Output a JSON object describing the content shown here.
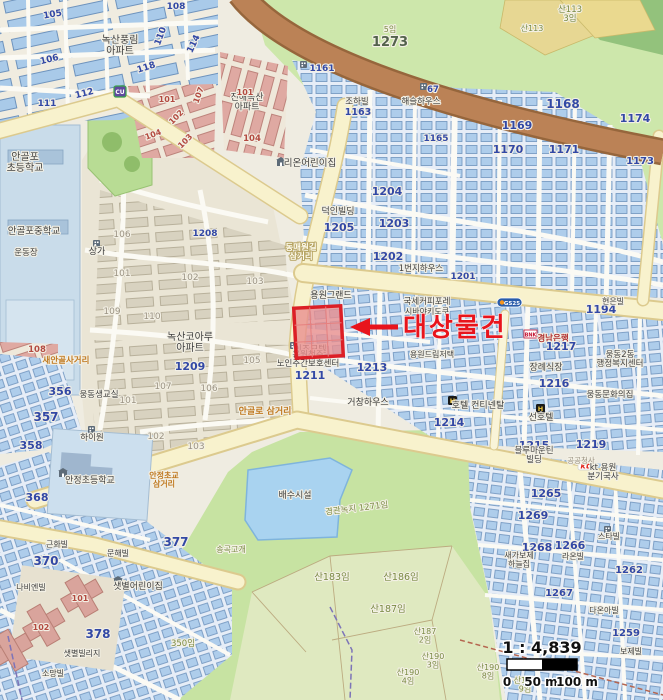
{
  "map": {
    "target": {
      "label": "대상물건",
      "color": "#e8141c"
    },
    "scalebar": {
      "ratio": "1 : 4,839",
      "tick0": "0",
      "tick1": "50 m",
      "tick2": "100 m"
    },
    "colors": {
      "target_red": "#e8141c",
      "parcel_fill": "#e88f8f",
      "building_blue": "#aecdeb",
      "road_yellow": "#f8f2cd",
      "road_brown": "#bb8256",
      "water_blue": "#a9d3f0",
      "green_hill": "#cde7ab"
    },
    "icons": [
      {
        "type": "cu",
        "x": 114,
        "y": 86
      },
      {
        "type": "gs25",
        "x": 497,
        "y": 298
      },
      {
        "type": "kt",
        "x": 578,
        "y": 461
      },
      {
        "type": "bnk",
        "x": 524,
        "y": 330
      },
      {
        "type": "school",
        "x": 276,
        "y": 157
      },
      {
        "type": "school",
        "x": 58,
        "y": 468
      },
      {
        "type": "school",
        "x": 113,
        "y": 576
      },
      {
        "type": "bld",
        "x": 93,
        "y": 240
      },
      {
        "type": "bld",
        "x": 300,
        "y": 61
      },
      {
        "type": "bld",
        "x": 420,
        "y": 83
      },
      {
        "type": "bld",
        "x": 290,
        "y": 342
      },
      {
        "type": "bld",
        "x": 88,
        "y": 426
      },
      {
        "type": "bld",
        "x": 604,
        "y": 526
      },
      {
        "type": "hotel",
        "x": 448,
        "y": 396
      },
      {
        "type": "hotel",
        "x": 536,
        "y": 404
      }
    ],
    "labels": [
      {
        "t": "108",
        "x": 176,
        "y": 9,
        "k": "bn",
        "s": 9
      },
      {
        "t": "105",
        "x": 53,
        "y": 17,
        "k": "bn",
        "s": 9,
        "r": -10
      },
      {
        "t": "녹산풍림\n아파트",
        "x": 120,
        "y": 43,
        "k": "nm",
        "s": 10
      },
      {
        "t": "110",
        "x": 163,
        "y": 37,
        "k": "bn",
        "s": 9,
        "r": -70
      },
      {
        "t": "114",
        "x": 196,
        "y": 45,
        "k": "bn",
        "s": 9,
        "r": -65
      },
      {
        "t": "106",
        "x": 50,
        "y": 62,
        "k": "bn",
        "s": 9,
        "r": -14
      },
      {
        "t": "118",
        "x": 147,
        "y": 70,
        "k": "bn",
        "s": 9,
        "r": -18
      },
      {
        "t": "112",
        "x": 85,
        "y": 96,
        "k": "bn",
        "s": 9,
        "r": -14
      },
      {
        "t": "111",
        "x": 47,
        "y": 106,
        "k": "bn",
        "s": 9
      },
      {
        "t": "101",
        "x": 167,
        "y": 102,
        "k": "pk",
        "s": 8
      },
      {
        "t": "107",
        "x": 201,
        "y": 96,
        "k": "pk",
        "s": 8,
        "r": -70
      },
      {
        "t": "102",
        "x": 178,
        "y": 119,
        "k": "pk",
        "s": 8,
        "r": -45
      },
      {
        "t": "104",
        "x": 154,
        "y": 137,
        "k": "pk",
        "s": 8,
        "r": -20
      },
      {
        "t": "103",
        "x": 187,
        "y": 143,
        "k": "pk",
        "s": 8,
        "r": -45
      },
      {
        "t": "진해녹산\n아파트",
        "x": 247,
        "y": 100,
        "k": "nm",
        "s": 9
      },
      {
        "t": "101",
        "x": 245,
        "y": 95,
        "k": "pk",
        "s": 8
      },
      {
        "t": "104",
        "x": 252,
        "y": 141,
        "k": "pk",
        "s": 8.5
      },
      {
        "t": "안골포\n초등학교",
        "x": 25,
        "y": 160,
        "k": "nm",
        "s": 10
      },
      {
        "t": "안골포중학교",
        "x": 34,
        "y": 234,
        "k": "nm",
        "s": 9.5
      },
      {
        "t": "운동장",
        "x": 26,
        "y": 255,
        "k": "nm",
        "s": 8.5
      },
      {
        "t": "리온어린이집",
        "x": 310,
        "y": 166,
        "k": "nm",
        "s": 9.5
      },
      {
        "t": "상가",
        "x": 97,
        "y": 254,
        "k": "nm",
        "s": 9
      },
      {
        "t": "1208",
        "x": 205,
        "y": 236,
        "k": "bn",
        "s": 9
      },
      {
        "t": "106",
        "x": 122,
        "y": 237,
        "k": "gy",
        "s": 9
      },
      {
        "t": "101",
        "x": 122,
        "y": 276,
        "k": "gy",
        "s": 9
      },
      {
        "t": "102",
        "x": 190,
        "y": 280,
        "k": "gy",
        "s": 9
      },
      {
        "t": "103",
        "x": 255,
        "y": 284,
        "k": "gy",
        "s": 9
      },
      {
        "t": "109",
        "x": 112,
        "y": 314,
        "k": "gy",
        "s": 9
      },
      {
        "t": "110",
        "x": 152,
        "y": 319,
        "k": "gy",
        "s": 9
      },
      {
        "t": "105",
        "x": 252,
        "y": 363,
        "k": "gy",
        "s": 9
      },
      {
        "t": "녹산코아루\n아파트",
        "x": 190,
        "y": 340,
        "k": "nm",
        "s": 10
      },
      {
        "t": "1209",
        "x": 190,
        "y": 370,
        "k": "bn",
        "s": 11
      },
      {
        "t": "5임",
        "x": 390,
        "y": 32,
        "k": "gr",
        "s": 8
      },
      {
        "t": "1273",
        "x": 390,
        "y": 46,
        "k": "gd",
        "s": 13
      },
      {
        "t": "1161",
        "x": 322,
        "y": 71,
        "k": "bn",
        "s": 9
      },
      {
        "t": "조하빌",
        "x": 357,
        "y": 104,
        "k": "nm",
        "s": 8.5
      },
      {
        "t": "1163",
        "x": 358,
        "y": 115,
        "k": "bn",
        "s": 9.5
      },
      {
        "t": "해슬하우스",
        "x": 421,
        "y": 104,
        "k": "nm",
        "s": 8.5
      },
      {
        "t": "67",
        "x": 433,
        "y": 92,
        "k": "bn",
        "s": 8.5
      },
      {
        "t": "1165",
        "x": 436,
        "y": 141,
        "k": "bn",
        "s": 9
      },
      {
        "t": "1168",
        "x": 563,
        "y": 108,
        "k": "bn",
        "s": 12
      },
      {
        "t": "1169",
        "x": 517,
        "y": 129,
        "k": "bn",
        "s": 11
      },
      {
        "t": "1170",
        "x": 508,
        "y": 153,
        "k": "bn",
        "s": 11
      },
      {
        "t": "1171",
        "x": 564,
        "y": 153,
        "k": "bn",
        "s": 11
      },
      {
        "t": "1174",
        "x": 635,
        "y": 122,
        "k": "bn",
        "s": 11
      },
      {
        "t": "1173",
        "x": 640,
        "y": 164,
        "k": "bn",
        "s": 10
      },
      {
        "t": "산113\n3임",
        "x": 570,
        "y": 12,
        "k": "gr",
        "s": 8.5
      },
      {
        "t": "산113",
        "x": 532,
        "y": 31,
        "k": "gr",
        "s": 8
      },
      {
        "t": "덕인빌딩",
        "x": 338,
        "y": 214,
        "k": "nm",
        "s": 9
      },
      {
        "t": "1205",
        "x": 339,
        "y": 231,
        "k": "bn",
        "s": 11
      },
      {
        "t": "1204",
        "x": 387,
        "y": 195,
        "k": "bn",
        "s": 11
      },
      {
        "t": "1203",
        "x": 394,
        "y": 227,
        "k": "bn",
        "s": 11
      },
      {
        "t": "1202",
        "x": 388,
        "y": 260,
        "k": "bn",
        "s": 11
      },
      {
        "t": "1번지하우스",
        "x": 421,
        "y": 271,
        "k": "nm",
        "s": 8.5
      },
      {
        "t": "1201",
        "x": 463,
        "y": 279,
        "k": "bn",
        "s": 9
      },
      {
        "t": "동매원길\n삼거리",
        "x": 301,
        "y": 250,
        "k": "wr",
        "s": 8.5
      },
      {
        "t": "용원그랜드",
        "x": 331,
        "y": 298,
        "k": "nm",
        "s": 9
      },
      {
        "t": "국세커피포레",
        "x": 427,
        "y": 304,
        "k": "nm",
        "s": 8.5
      },
      {
        "t": "시바야키도쿠",
        "x": 427,
        "y": 314,
        "k": "nm",
        "s": 8
      },
      {
        "t": "이즈모텔",
        "x": 310,
        "y": 352,
        "k": "nm",
        "s": 9
      },
      {
        "t": "용원천주\n노인주간보호센터",
        "x": 308,
        "y": 357,
        "k": "nm",
        "s": 8.5
      },
      {
        "t": "1211",
        "x": 310,
        "y": 379,
        "k": "bn",
        "s": 11
      },
      {
        "t": "1213",
        "x": 372,
        "y": 371,
        "k": "bn",
        "s": 11
      },
      {
        "t": "거창하우스",
        "x": 368,
        "y": 405,
        "k": "nm",
        "s": 9
      },
      {
        "t": "용원드림저택",
        "x": 432,
        "y": 357,
        "k": "nm",
        "s": 8
      },
      {
        "t": "경남은행",
        "x": 553,
        "y": 341,
        "k": "rd2",
        "s": 8.5
      },
      {
        "t": "1217",
        "x": 561,
        "y": 350,
        "k": "bn",
        "s": 11
      },
      {
        "t": "장례식장",
        "x": 546,
        "y": 370,
        "k": "nm",
        "s": 9
      },
      {
        "t": "1194",
        "x": 601,
        "y": 313,
        "k": "bn",
        "s": 11
      },
      {
        "t": "현은빌",
        "x": 613,
        "y": 304,
        "k": "nm",
        "s": 8
      },
      {
        "t": "웅동2동\n행정복지센터",
        "x": 620,
        "y": 357,
        "k": "nm",
        "s": 8.5
      },
      {
        "t": "웅동문화의집",
        "x": 610,
        "y": 397,
        "k": "nm",
        "s": 8.5
      },
      {
        "t": "1216",
        "x": 554,
        "y": 387,
        "k": "bn",
        "s": 11
      },
      {
        "t": "호텔 컨티넨탈",
        "x": 478,
        "y": 408,
        "k": "nm",
        "s": 9
      },
      {
        "t": "선호텔",
        "x": 541,
        "y": 420,
        "k": "nm",
        "s": 9
      },
      {
        "t": "1214",
        "x": 449,
        "y": 426,
        "k": "bn",
        "s": 11
      },
      {
        "t": "새안골사거리",
        "x": 66,
        "y": 363,
        "k": "or",
        "s": 8.5
      },
      {
        "t": "356",
        "x": 60,
        "y": 395,
        "k": "bn",
        "s": 11
      },
      {
        "t": "웅동생교실",
        "x": 99,
        "y": 397,
        "k": "nm",
        "s": 8.5
      },
      {
        "t": "357",
        "x": 46,
        "y": 421,
        "k": "bn",
        "s": 12
      },
      {
        "t": "358",
        "x": 31,
        "y": 449,
        "k": "bn",
        "s": 11
      },
      {
        "t": "368",
        "x": 37,
        "y": 501,
        "k": "bn",
        "s": 11
      },
      {
        "t": "하이원",
        "x": 92,
        "y": 440,
        "k": "nm",
        "s": 8.5
      },
      {
        "t": "안정초등학교",
        "x": 90,
        "y": 483,
        "k": "nm",
        "s": 9
      },
      {
        "t": "108",
        "x": 37,
        "y": 352,
        "k": "pk",
        "s": 8.5
      },
      {
        "t": "101",
        "x": 128,
        "y": 403,
        "k": "gy",
        "s": 9
      },
      {
        "t": "107",
        "x": 163,
        "y": 389,
        "k": "gy",
        "s": 9
      },
      {
        "t": "106",
        "x": 209,
        "y": 391,
        "k": "gy",
        "s": 9
      },
      {
        "t": "102",
        "x": 156,
        "y": 439,
        "k": "gy",
        "s": 9
      },
      {
        "t": "103",
        "x": 196,
        "y": 449,
        "k": "gy",
        "s": 9
      },
      {
        "t": "안정초교\n삼거리",
        "x": 164,
        "y": 478,
        "k": "or",
        "s": 8
      },
      {
        "t": "안골로 삼거리",
        "x": 265,
        "y": 414,
        "k": "or",
        "s": 9
      },
      {
        "t": "370",
        "x": 46,
        "y": 565,
        "k": "bn",
        "s": 12
      },
      {
        "t": "377",
        "x": 176,
        "y": 546,
        "k": "bn",
        "s": 12
      },
      {
        "t": "378",
        "x": 98,
        "y": 638,
        "k": "bn",
        "s": 12
      },
      {
        "t": "근화빌",
        "x": 57,
        "y": 547,
        "k": "nm",
        "s": 8
      },
      {
        "t": "문해빌",
        "x": 118,
        "y": 556,
        "k": "nm",
        "s": 8
      },
      {
        "t": "나비엔빌",
        "x": 31,
        "y": 590,
        "k": "nm",
        "s": 8
      },
      {
        "t": "샛별어린이집",
        "x": 138,
        "y": 589,
        "k": "nm",
        "s": 9
      },
      {
        "t": "샛별빌리지",
        "x": 82,
        "y": 656,
        "k": "nm",
        "s": 8
      },
      {
        "t": "소망빌",
        "x": 53,
        "y": 676,
        "k": "nm",
        "s": 8
      },
      {
        "t": "101",
        "x": 80,
        "y": 601,
        "k": "pk",
        "s": 8
      },
      {
        "t": "102",
        "x": 41,
        "y": 630,
        "k": "pk",
        "s": 8
      },
      {
        "t": "배수시설",
        "x": 295,
        "y": 498,
        "k": "nm",
        "s": 9
      },
      {
        "t": "경관녹지 1271임",
        "x": 357,
        "y": 511,
        "k": "gr",
        "s": 8.5,
        "r": -7
      },
      {
        "t": "송곡고개",
        "x": 231,
        "y": 552,
        "k": "gr",
        "s": 8
      },
      {
        "t": "350임",
        "x": 183,
        "y": 646,
        "k": "gr",
        "s": 8.5
      },
      {
        "t": "산183임",
        "x": 332,
        "y": 580,
        "k": "gr",
        "s": 9.5
      },
      {
        "t": "산186임",
        "x": 401,
        "y": 580,
        "k": "gr",
        "s": 9.5
      },
      {
        "t": "산187임",
        "x": 388,
        "y": 612,
        "k": "gr",
        "s": 9.5
      },
      {
        "t": "산187\n2임",
        "x": 425,
        "y": 634,
        "k": "gr",
        "s": 8
      },
      {
        "t": "산190\n3임",
        "x": 433,
        "y": 659,
        "k": "gr",
        "s": 8
      },
      {
        "t": "산190\n4임",
        "x": 408,
        "y": 675,
        "k": "gr",
        "s": 8
      },
      {
        "t": "산190\n8임",
        "x": 488,
        "y": 670,
        "k": "gr",
        "s": 8
      },
      {
        "t": "산192\n9임",
        "x": 525,
        "y": 683,
        "k": "gr",
        "s": 8
      },
      {
        "t": "1215",
        "x": 534,
        "y": 449,
        "k": "bn",
        "s": 11
      },
      {
        "t": "블루마운틴\n빌딩",
        "x": 534,
        "y": 453,
        "k": "nm",
        "s": 8.5
      },
      {
        "t": "1219",
        "x": 591,
        "y": 448,
        "k": "bn",
        "s": 11
      },
      {
        "t": "공공청사",
        "x": 581,
        "y": 463,
        "k": "gy",
        "s": 7.5
      },
      {
        "t": "kt 용원\n분기국사",
        "x": 603,
        "y": 470,
        "k": "nm",
        "s": 8.5
      },
      {
        "t": "1265",
        "x": 546,
        "y": 497,
        "k": "bn",
        "s": 11
      },
      {
        "t": "1269",
        "x": 533,
        "y": 519,
        "k": "bn",
        "s": 11
      },
      {
        "t": "1268",
        "x": 537,
        "y": 551,
        "k": "bn",
        "s": 11
      },
      {
        "t": "1266",
        "x": 570,
        "y": 549,
        "k": "bn",
        "s": 11
      },
      {
        "t": "라온빌",
        "x": 573,
        "y": 559,
        "k": "nm",
        "s": 8
      },
      {
        "t": "스타빌",
        "x": 609,
        "y": 539,
        "k": "nm",
        "s": 8
      },
      {
        "t": "새가보제\n하늘집",
        "x": 519,
        "y": 558,
        "k": "nm",
        "s": 8
      },
      {
        "t": "1262",
        "x": 629,
        "y": 573,
        "k": "bn",
        "s": 10
      },
      {
        "t": "1267",
        "x": 559,
        "y": 596,
        "k": "bn",
        "s": 10
      },
      {
        "t": "다온아빌",
        "x": 604,
        "y": 613,
        "k": "nm",
        "s": 8
      },
      {
        "t": "1259",
        "x": 626,
        "y": 636,
        "k": "bn",
        "s": 10
      },
      {
        "t": "보제빌",
        "x": 631,
        "y": 654,
        "k": "nm",
        "s": 8
      }
    ]
  }
}
